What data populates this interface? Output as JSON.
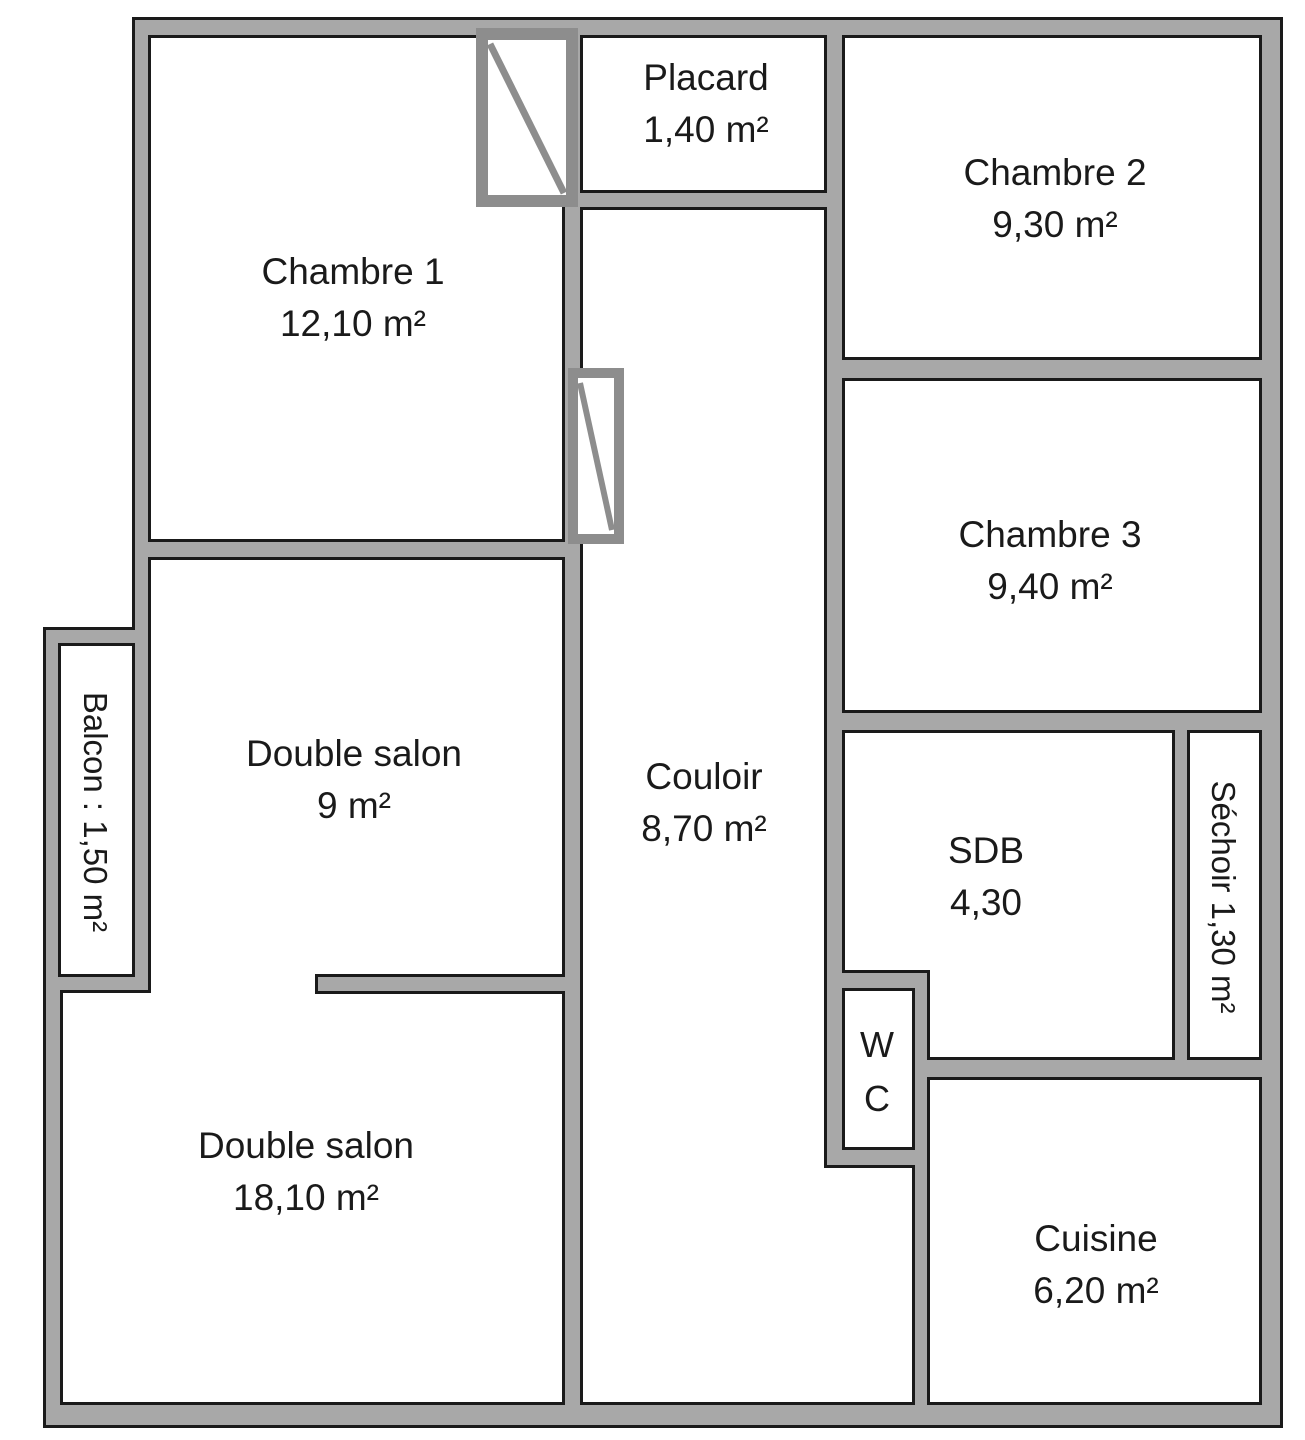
{
  "rooms": {
    "chambre1": {
      "name": "Chambre 1",
      "area": "12,10 m²"
    },
    "placard": {
      "name": "Placard",
      "area": "1,40 m²"
    },
    "chambre2": {
      "name": "Chambre 2",
      "area": "9,30 m²"
    },
    "chambre3": {
      "name": "Chambre 3",
      "area": "9,40 m²"
    },
    "double_salon_haut": {
      "name": "Double salon",
      "area": "9 m²"
    },
    "couloir": {
      "name": "Couloir",
      "area": "8,70 m²"
    },
    "balcon": {
      "name": "Balcon : 1,50 m²"
    },
    "sdb": {
      "name": "SDB",
      "area": "4,30"
    },
    "sechoir": {
      "name": "Séchoir 1,30 m²"
    },
    "wc": {
      "line1": "W",
      "line2": "C"
    },
    "double_salon_bas": {
      "name": "Double salon",
      "area": "18,10 m²"
    },
    "cuisine": {
      "name": "Cuisine",
      "area": "6,20 m²"
    }
  },
  "icons": {
    "closet_door_top": "closet-door-symbol",
    "closet_door_side": "closet-door-symbol"
  },
  "colors": {
    "wall_fill": "#a8a8a8",
    "wall_outline": "#1a1a1a",
    "door_symbol": "#8d8d8d",
    "room_fill": "#ffffff",
    "text": "#1a1a1a",
    "background": "#ffffff"
  }
}
